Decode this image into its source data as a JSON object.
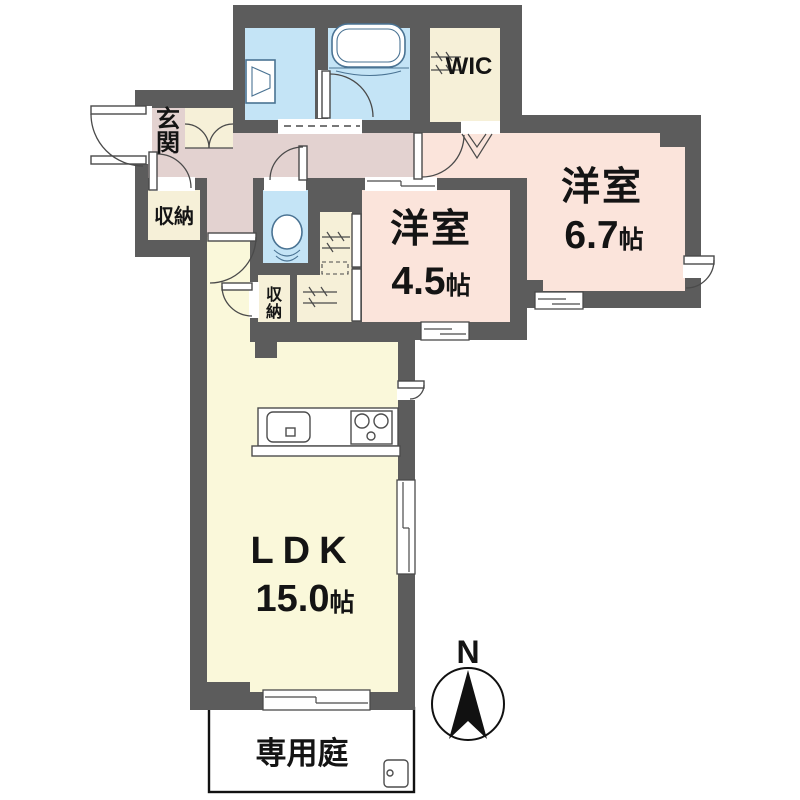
{
  "plan_title": "apartment-floor-plan",
  "colors": {
    "wall": "#5C5C5C",
    "water": "#C4E4F6",
    "room": "#FBE4DB",
    "hall": "#E3D2D0",
    "ldk": "#FAF8DA",
    "storage": "#F6F0D8",
    "line": "#4A4A4A",
    "fixture": "#4A7393",
    "text": "#141414",
    "garden_border": "#111111"
  },
  "rooms": {
    "entrance": {
      "label": "玄関",
      "chars": [
        "玄",
        "関"
      ]
    },
    "entrance_storage": {
      "label": "収納"
    },
    "hall_storage": {
      "label": "収納",
      "chars": [
        "収",
        "納"
      ]
    },
    "wic": {
      "label": "WIC"
    },
    "bedroom_45": {
      "type_label": "洋室",
      "size": "4.5",
      "size_unit": "帖"
    },
    "bedroom_67": {
      "type_label": "洋室",
      "size": "6.7",
      "size_unit": "帖"
    },
    "ldk": {
      "type_label": "LDK",
      "size": "15.0",
      "size_unit": "帖"
    },
    "garden": {
      "label": "専用庭"
    }
  },
  "compass": {
    "north_label": "N"
  }
}
